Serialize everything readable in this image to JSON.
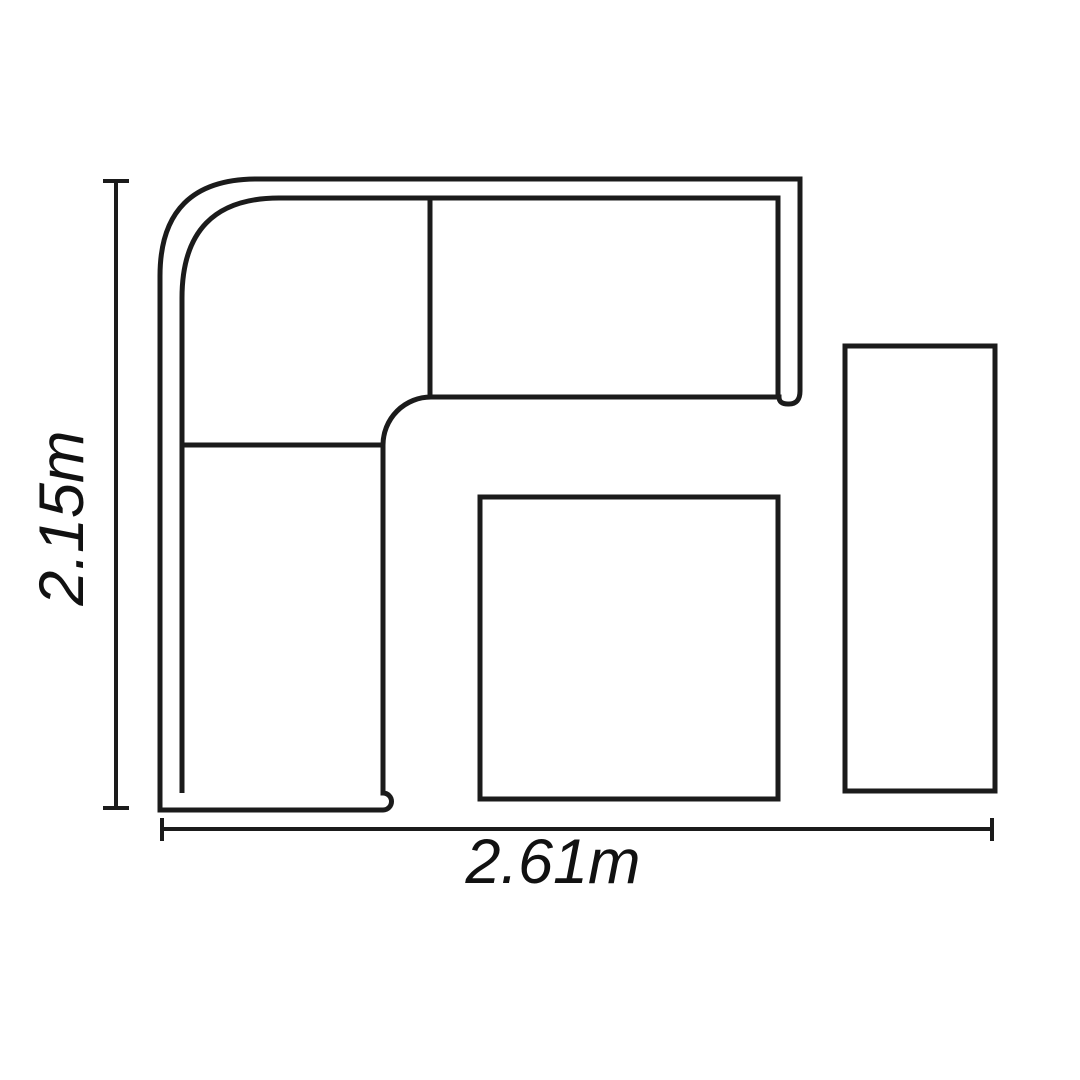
{
  "diagram": {
    "labels": {
      "height": "2.15m",
      "width": "2.61m"
    },
    "shapes": [
      "corner-sofa",
      "square-table",
      "side-bench"
    ],
    "colors": {
      "background": "#ffffff",
      "line": "#1b1b1b",
      "text": "#111111"
    }
  }
}
